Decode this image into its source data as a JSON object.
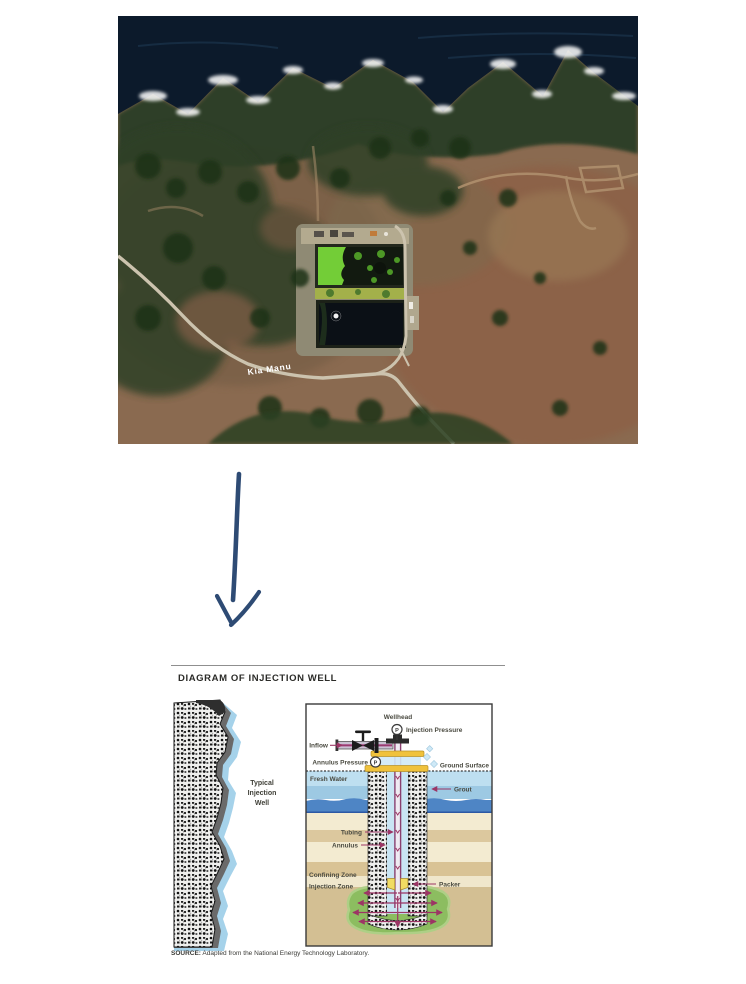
{
  "satellite": {
    "description": "aerial-photo-coastal-wastewater-treatment-facility",
    "road_label": "Kia Manu"
  },
  "diagram": {
    "title": "DIAGRAM OF INJECTION WELL",
    "well_type_label": [
      "Typical",
      "Injection",
      "Well"
    ],
    "labels": {
      "wellhead": "Wellhead",
      "injection_pressure": "Injection Pressure",
      "inflow": "Inflow",
      "annulus_pressure": "Annulus Pressure",
      "ground_surface": "Ground Surface",
      "fresh_water": "Fresh Water",
      "grout": "Grout",
      "tubing": "Tubing",
      "annulus": "Annulus",
      "confining_zone": "Confining Zone",
      "injection_zone": "Injection Zone",
      "packer": "Packer",
      "pressure_gauge_letter": "P"
    },
    "source": {
      "prefix": "SOURCE:",
      "text": " Adapted from the National Energy Technology Laboratory."
    }
  },
  "colors": {
    "arrow_blue": "#2e4b74",
    "label_arrow_magenta": "#9c3565",
    "fresh_water_pale": "#bedff0",
    "fresh_water_mid": "#9dc9e3",
    "deep_water_blue": "#4e85c5",
    "layer_cream": "#f3ebd1",
    "layer_tan": "#dcc89e",
    "injection_zone_tan": "#d3bf93",
    "injection_green": "#8cbd60",
    "flange_yellow": "#f0c23c",
    "packer_yellow": "#f1dc63",
    "ocean_navy": "#0c1a2b"
  }
}
